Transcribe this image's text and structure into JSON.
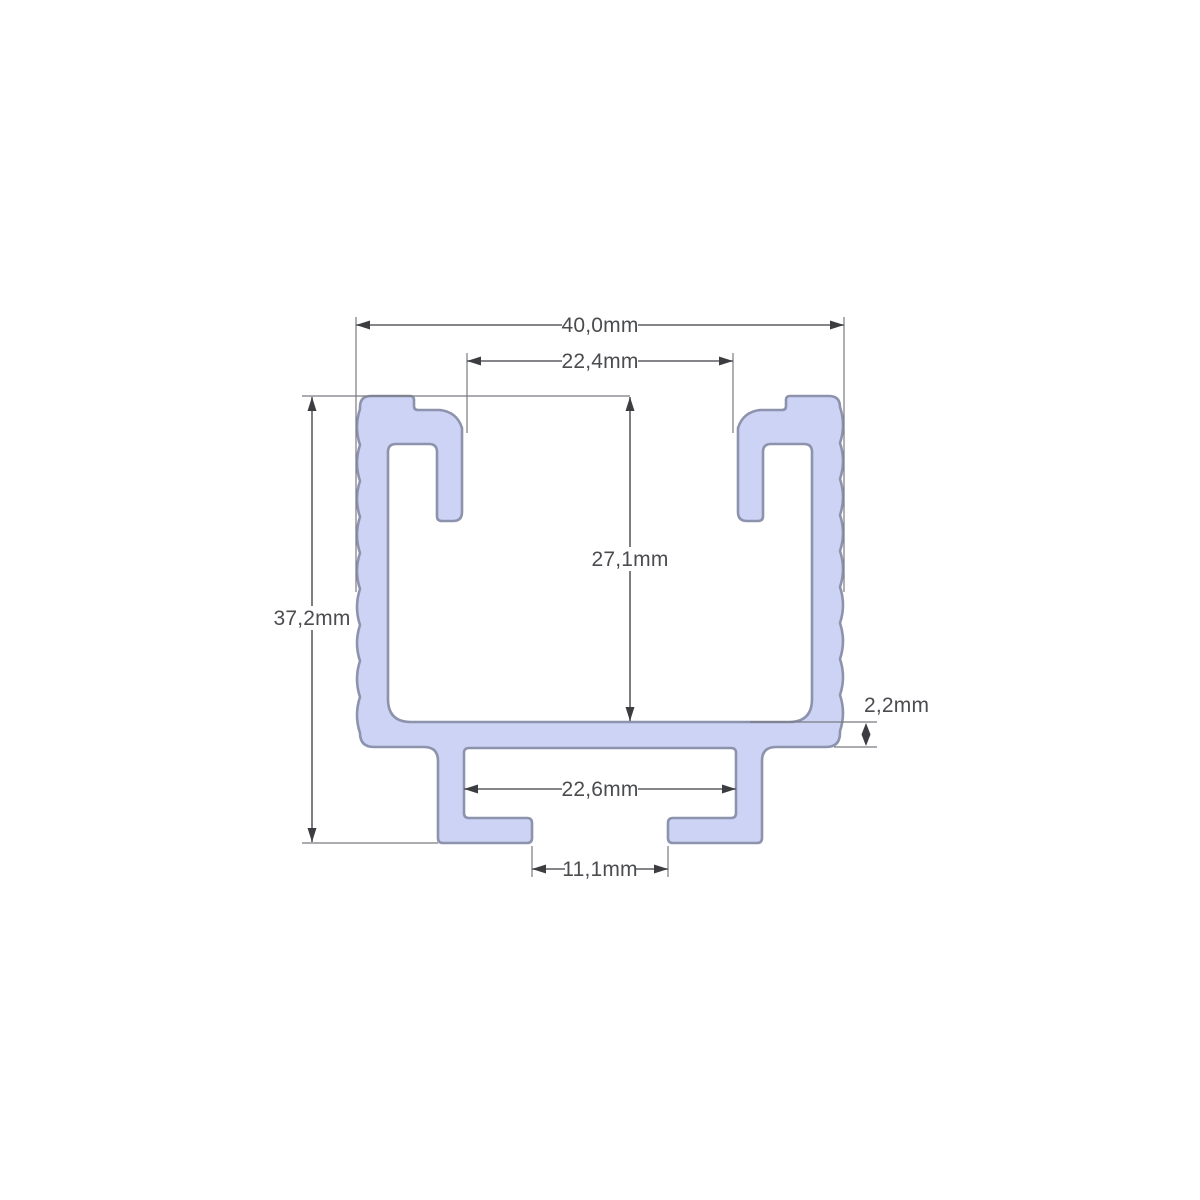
{
  "diagram": {
    "kind": "cross-section technical drawing of a C-channel mounting rail profile",
    "unit": "mm",
    "colors": {
      "profile_fill": "#cdd3f4",
      "profile_outline": "#8d93ad",
      "dimension_line": "#5d5e62",
      "label_text": "#4b4c4f",
      "background": "#ffffff"
    },
    "dimensions": {
      "overall_width": {
        "label": "40,0mm",
        "value": 40.0,
        "orientation": "horizontal"
      },
      "top_opening_width": {
        "label": "22,4mm",
        "value": 22.4,
        "orientation": "horizontal"
      },
      "inner_depth": {
        "label": "27,1mm",
        "value": 27.1,
        "orientation": "vertical"
      },
      "overall_height": {
        "label": "37,2mm",
        "value": 37.2,
        "orientation": "vertical"
      },
      "base_thickness": {
        "label": "2,2mm",
        "value": 2.2,
        "orientation": "vertical"
      },
      "bottom_channel_width": {
        "label": "22,6mm",
        "value": 22.6,
        "orientation": "horizontal"
      },
      "bottom_slot_opening": {
        "label": "11,1mm",
        "value": 11.1,
        "orientation": "horizontal"
      }
    }
  }
}
